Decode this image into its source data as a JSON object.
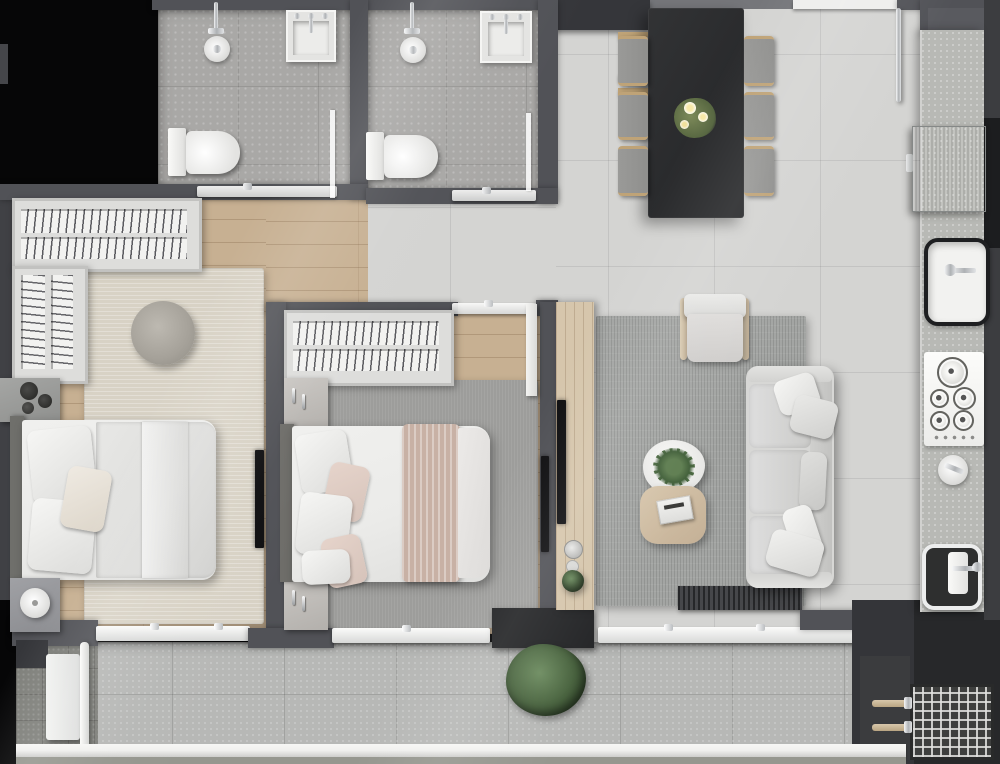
{
  "title": "apartment-floor-plan-top-view",
  "colors": {
    "void": "#060607",
    "wall": "#515257",
    "wall_dark": "#35363a",
    "wall_light": "#75767a",
    "floor_tile": "#d4d4d2",
    "bath_tile": "#a9a8a6",
    "balcony_tile": "#b7b8b6",
    "paving": "#7f807b",
    "wood": "#c7b092",
    "wood_light": "#d6c6ac",
    "counter": "#b8b9b5",
    "steel": "#a6a8a7",
    "table_dark": "#292a2c",
    "chair": "#8f8f8d",
    "wood_accent": "#bfa377",
    "rug_beige": "#d8d2c5",
    "rug_gray": "#9d9d9b",
    "rug_living": "#a3a5a3",
    "sofa": "#d7d7d5",
    "linen": "#ebebe9",
    "blush": "#d6c3ba",
    "throw": "#c8b1a5",
    "headboard": "#6f6f6b",
    "plant": "#46603c",
    "plant_dark": "#2e4228",
    "chrome": "#d9dbdd",
    "fixture_white": "#f3f3f1",
    "tv": "#0f0f11",
    "glass": "#eef0ef",
    "railing": "#f0f0ee",
    "mat": "#46474a"
  },
  "rooms": [
    {
      "name": "bathroom-1",
      "furniture": [
        "walk-in-shower",
        "wall-sink",
        "toilet",
        "glass-partition",
        "glass-door"
      ]
    },
    {
      "name": "bathroom-2",
      "furniture": [
        "walk-in-shower",
        "wall-sink",
        "toilet",
        "glass-partition",
        "glass-door"
      ]
    },
    {
      "name": "bedroom-1",
      "furniture": [
        "l-shaped-wardrobe-with-hangers",
        "double-bed",
        "pillows",
        "round-pouf",
        "beige-rug",
        "side-cabinet-with-vases",
        "nightstand-with-lamp",
        "wall-tv"
      ]
    },
    {
      "name": "bedroom-2",
      "furniture": [
        "wardrobe-with-hangers",
        "double-bed-with-blush-throw",
        "nightstand",
        "nightstand",
        "gray-rug",
        "wall-tv",
        "sliding-door"
      ]
    },
    {
      "name": "living-room",
      "furniture": [
        "three-seat-sofa",
        "armchair",
        "round-coffee-table-with-fern",
        "wood-side-table-with-book",
        "area-rug",
        "media-console-with-tv",
        "doormat"
      ]
    },
    {
      "name": "dining-area",
      "furniture": [
        "dark-dining-table",
        "dining-chair-x6",
        "flower-vase",
        "coat-rack",
        "entry-door"
      ]
    },
    {
      "name": "kitchen",
      "furniture": [
        "refrigerator",
        "counter-run",
        "main-sink",
        "five-burner-cooktop",
        "round-prep-sink",
        "secondary-sink"
      ]
    },
    {
      "name": "balcony",
      "furniture": [
        "sliding-glass-doors",
        "planter-bush",
        "ac-unit",
        "condenser-grate",
        "railing"
      ]
    }
  ]
}
